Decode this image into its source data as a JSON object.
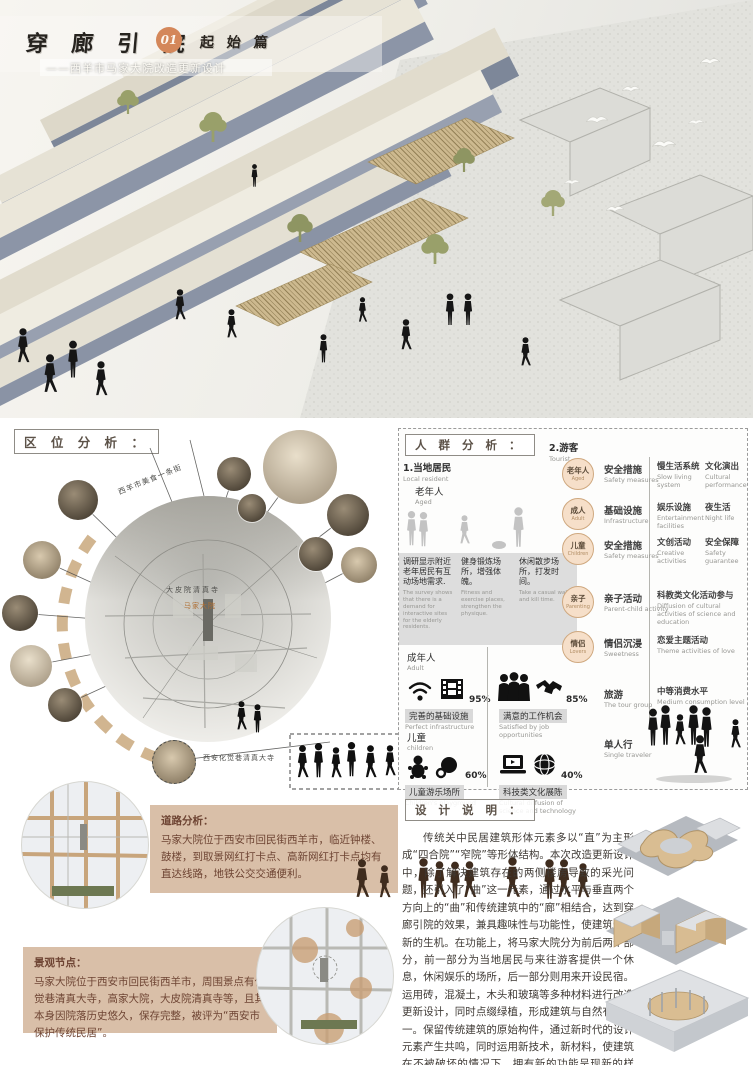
{
  "header": {
    "title": "穿 廊 引 院",
    "number": "01",
    "chapter": "起 始 篇",
    "subtitle": "——西羊市马家大院改造更新设计"
  },
  "sections": {
    "location_label": "区 位 分 析 ：",
    "crowd_label": "人 群 分 析 ：",
    "design_label": "设 计 说 明 ："
  },
  "location": {
    "arc_label": "西羊市美食一条街",
    "map_label": "大皮院清真寺",
    "site_label": "马家大院",
    "mosque_label": "西安化觉巷清真大寺"
  },
  "crowd": {
    "local": {
      "title": "1.当地居民",
      "title_en": "Local resident",
      "aged": "老年人",
      "aged_en": "Aged",
      "notes": [
        {
          "zh": "调研显示附近老年居民有互动场地需求.",
          "en": "The survey shows that there is a demand for interactive sites for the elderly residents."
        },
        {
          "zh": "健身锻炼场所，增强体魄。",
          "en": "Fitness and exercise places, strengthen the physique."
        },
        {
          "zh": "休闲散步场所，打发时间。",
          "en": "Take a casual walk and kill time."
        }
      ],
      "adult": "成年人",
      "adult_en": "Adult",
      "infra_pct": "95%",
      "infra": "完善的基础设施",
      "infra_en": "Perfect infrastructure",
      "jobs_pct": "85%",
      "jobs": "满意的工作机会",
      "jobs_en": "Satisfied by job opportunities",
      "child": "儿童",
      "child_en": "children",
      "play_pct": "60%",
      "play": "儿童游乐场所",
      "play_en": "Children's playground",
      "tech_pct": "40%",
      "tech": "科技类文化展陈",
      "tech_en": "Cultural diffusion of science and technology"
    },
    "tourist": {
      "title": "2.游客",
      "title_en": "Tourist",
      "rows": [
        {
          "tag": "老年人",
          "tag_en": "Aged",
          "need": "安全措施",
          "need_en": "Safety measures",
          "a1": "慢生活系统",
          "a1_en": "Slow living system",
          "a2": "文化演出",
          "a2_en": "Cultural performance"
        },
        {
          "tag": "成人",
          "tag_en": "Adult",
          "need": "基础设施",
          "need_en": "Infrastructure",
          "a1": "娱乐设施",
          "a1_en": "Entertainment facilities",
          "a2": "夜生活",
          "a2_en": "Night life"
        },
        {
          "tag": "儿童",
          "tag_en": "Children",
          "need": "安全措施",
          "need_en": "Safety measures",
          "a1": "文创活动",
          "a1_en": "Creative activities",
          "a2": "安全保障",
          "a2_en": "Safety guarantee"
        },
        {
          "tag": "亲子",
          "tag_en": "Parenting",
          "need": "亲子活动",
          "need_en": "Parent-child activity",
          "a1": "科教类文化活动参与",
          "a1_en": "Diffusion of cultural activities of science and education"
        },
        {
          "tag": "情侣",
          "tag_en": "Lovers",
          "need": "情侣沉浸",
          "need_en": "Sweetness",
          "a1": "恋爱主题活动",
          "a1_en": "Theme activities of love"
        },
        {
          "need": "旅游",
          "need_en": "The tour group",
          "a1": "中等消费水平",
          "a1_en": "Medium consumption level"
        },
        {
          "need": "单人行",
          "need_en": "Single traveler"
        }
      ]
    }
  },
  "road": {
    "title": "道路分析：",
    "text": "马家大院位于西安市回民街西羊市，临近钟楼、鼓楼，到取景网红打卡点、高新网红打卡点均有直达线路，地铁公交交通便利。"
  },
  "landscape": {
    "title": "景观节点：",
    "text": "马家大院位于西安市回民街西羊市，周围景点有化觉巷清真大寺，高家大院，大皮院清真寺等，且其本身因院落历史悠久，保存完整，被评为“西安市保护传统民居”。"
  },
  "design": {
    "text": "传统关中民居建筑形体元素多以“直”为主形成“四合院”“窄院”等形体结构。本次改造更新设计中，除了解决建筑存在的两侧楼房导致的采光问题，还引入了“曲”这一元素，通过水平与垂直两个方向上的“曲”和传统建筑中的“廊”相结合，达到穿廊引院的效果，兼具趣味性与功能性，使建筑焕发新的生机。在功能上，将马家大院分为前后两个部分，前一部分为当地居民与来往游客提供一个休息，休闲娱乐的场所，后一部分则用来开设民宿。运用砖，混凝土，木头和玻璃等多种材料进行改造更新设计，同时点缀绿植，形成建筑与自然有机统一。保留传统建筑的原始构件，通过新时代的设计元素产生共鸣，同时运用新技术，新材料，使建筑在不被破坏的情况下，拥有新的功能呈现新的样貌。"
  },
  "icons": {
    "infrastructure": [
      "wifi-icon",
      "film-reel-icon"
    ],
    "jobs": [
      "crowd-icon",
      "handshake-icon"
    ],
    "children": [
      "baby-icon",
      "pacifier-icon"
    ],
    "technology": [
      "laptop-icon",
      "globe-icon"
    ]
  },
  "colors": {
    "accent_orange": "#d4875a",
    "tan_panel": "#d9bfa8",
    "tan_dash": "#c9a87c",
    "circle_fill": "#f6dfc9",
    "circle_border": "#cfa87f",
    "wall_blue": "#8c95a7",
    "roof_cream": "#ece8dc",
    "silhouette_brown": "#3f2c1e"
  }
}
